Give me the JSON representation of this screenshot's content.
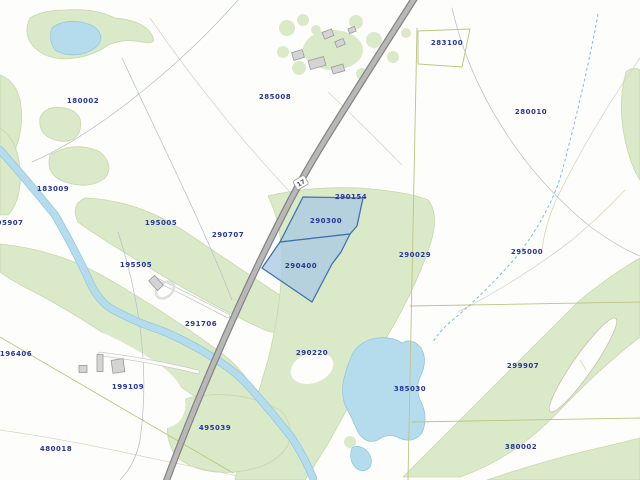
{
  "map": {
    "description": "Cadastral parcel map view with selected parcels highlighted",
    "road": {
      "shield_label": "17"
    },
    "selection": {
      "parcel_ids": [
        "290300",
        "290400"
      ]
    },
    "parcels": [
      {
        "id": "180002",
        "x": 83,
        "y": 103
      },
      {
        "id": "285008",
        "x": 275,
        "y": 99
      },
      {
        "id": "283100",
        "x": 447,
        "y": 45
      },
      {
        "id": "280010",
        "x": 531,
        "y": 114
      },
      {
        "id": "183009",
        "x": 53,
        "y": 191
      },
      {
        "id": "95907",
        "x": 10,
        "y": 225
      },
      {
        "id": "195005",
        "x": 161,
        "y": 225
      },
      {
        "id": "290707",
        "x": 228,
        "y": 237
      },
      {
        "id": "195505",
        "x": 136,
        "y": 267
      },
      {
        "id": "290154",
        "x": 351,
        "y": 199
      },
      {
        "id": "290300",
        "x": 326,
        "y": 223
      },
      {
        "id": "290400",
        "x": 301,
        "y": 268
      },
      {
        "id": "290029",
        "x": 415,
        "y": 257
      },
      {
        "id": "295000",
        "x": 527,
        "y": 254
      },
      {
        "id": "291706",
        "x": 201,
        "y": 326
      },
      {
        "id": "196406",
        "x": 16,
        "y": 356
      },
      {
        "id": "290220",
        "x": 312,
        "y": 355
      },
      {
        "id": "199109",
        "x": 128,
        "y": 389
      },
      {
        "id": "385030",
        "x": 410,
        "y": 391
      },
      {
        "id": "299907",
        "x": 523,
        "y": 368
      },
      {
        "id": "495039",
        "x": 215,
        "y": 430
      },
      {
        "id": "480018",
        "x": 56,
        "y": 451
      },
      {
        "id": "380002",
        "x": 521,
        "y": 449
      }
    ],
    "colors": {
      "water": "#b5dcec",
      "water_edge": "#93c8dd",
      "stream_blue": "#85bcd6",
      "vegetation": "#daeac9",
      "vegetation_edge": "#c8d8aa",
      "road_fill": "#b8b8b8",
      "road_casing": "#828282",
      "building": "#d4d4d4",
      "building_edge": "#9a9a9a",
      "parcel_label_blue": "#27359c",
      "selection_fill": "#a9c9e3",
      "selection_stroke": "#3e74ab",
      "boundary_olive": "#bdc47f",
      "boundary_gray": "#b4bfc5",
      "contour_tan": "#dcd5c4"
    }
  }
}
